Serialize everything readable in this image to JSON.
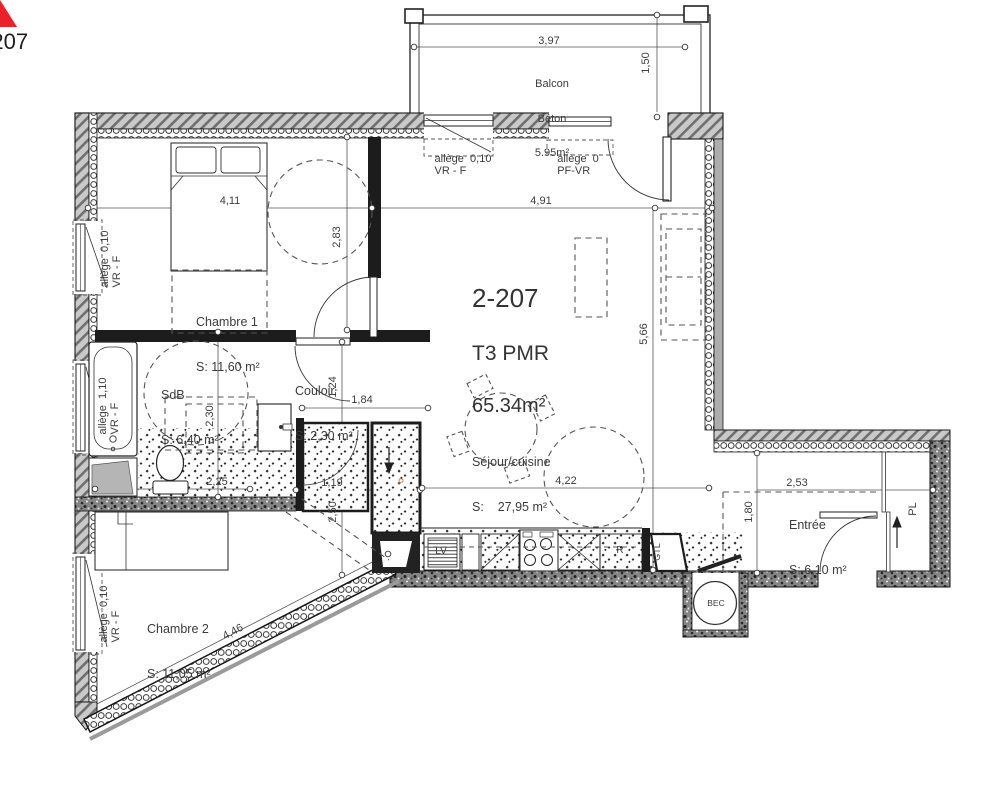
{
  "unit": {
    "number": "2-207",
    "type": "T3 PMR",
    "area": "65.34m²"
  },
  "marker": {
    "number": "2-207",
    "color": "#e8212b"
  },
  "rooms": {
    "balcon": {
      "line1": "Balcon",
      "line2": "Béton",
      "area": "5.95m²"
    },
    "chambre1": {
      "name": "Chambre 1",
      "area": "S: 11,60 m²"
    },
    "sdb": {
      "name": "SdB",
      "area": "S: 6,40 m²"
    },
    "couloir": {
      "name": "Couloir",
      "area": "S: 2,30 m²"
    },
    "sejour": {
      "name": "Séjour/cuisine",
      "area": "S:    27,95 m²"
    },
    "chambre2": {
      "name": "Chambre 2",
      "area": "S: 11,05 m²"
    },
    "entree": {
      "name": "Entrée",
      "area": "S: 6,10 m²"
    }
  },
  "labels": [
    {
      "text": "3,97",
      "x": 549,
      "y": 41
    },
    {
      "text": "1,50",
      "x": 646,
      "y": 63,
      "rot": -90
    },
    {
      "text": "4,11",
      "x": 230,
      "y": 201
    },
    {
      "text": "4,91",
      "x": 541,
      "y": 201
    },
    {
      "text": "2,83",
      "x": 337,
      "y": 237,
      "rot": -90
    },
    {
      "text": "5,66",
      "x": 644,
      "y": 334,
      "rot": -90
    },
    {
      "text": "2,30",
      "x": 210,
      "y": 416,
      "rot": -90
    },
    {
      "text": "1,24",
      "x": 333,
      "y": 387,
      "rot": -90
    },
    {
      "text": "1,84",
      "x": 362,
      "y": 400
    },
    {
      "text": "2,25",
      "x": 217,
      "y": 482
    },
    {
      "text": "1,19",
      "x": 332,
      "y": 483
    },
    {
      "text": "2,50",
      "x": 333,
      "y": 512,
      "rot": -90
    },
    {
      "text": "4,22",
      "x": 566,
      "y": 481
    },
    {
      "text": "2,53",
      "x": 797,
      "y": 483
    },
    {
      "text": "1,80",
      "x": 749,
      "y": 512,
      "rot": -90
    },
    {
      "text": "4,46",
      "x": 233,
      "y": 632,
      "rot": -28
    },
    {
      "text": "allège  0,10\nVR - F",
      "x": 463,
      "y": 165,
      "name": "window-allege-note"
    },
    {
      "text": "allège  0\nPF-VR",
      "x": 578,
      "y": 165,
      "name": "window-allege-note"
    },
    {
      "text": "allège  0,10\nVR - F",
      "x": 111,
      "y": 259,
      "rot": -90,
      "name": "window-allege-note"
    },
    {
      "text": "allège  1,10\nVR - F",
      "x": 109,
      "y": 406,
      "rot": -90,
      "name": "window-allege-note"
    },
    {
      "text": "allège  0,10\nVR - F",
      "x": 110,
      "y": 614,
      "rot": -90,
      "name": "window-allege-note"
    },
    {
      "text": "LV",
      "x": 441,
      "y": 552,
      "size": 10,
      "name": "appliance-label-lv"
    },
    {
      "text": "R",
      "x": 620,
      "y": 551,
      "size": 10,
      "name": "appliance-label-r"
    },
    {
      "text": "GTL",
      "x": 657,
      "y": 552,
      "rot": -90,
      "size": 9,
      "name": "gtl-label"
    },
    {
      "text": "BEC",
      "x": 716,
      "y": 603,
      "size": 8.5,
      "name": "bec-label"
    },
    {
      "text": "PL",
      "x": 913,
      "y": 509,
      "rot": -90,
      "size": 11,
      "name": "closet-label-pl"
    },
    {
      "text": "P",
      "x": 401,
      "y": 482,
      "size": 9,
      "color": "#bf7b35",
      "name": "duct-label-p"
    }
  ]
}
